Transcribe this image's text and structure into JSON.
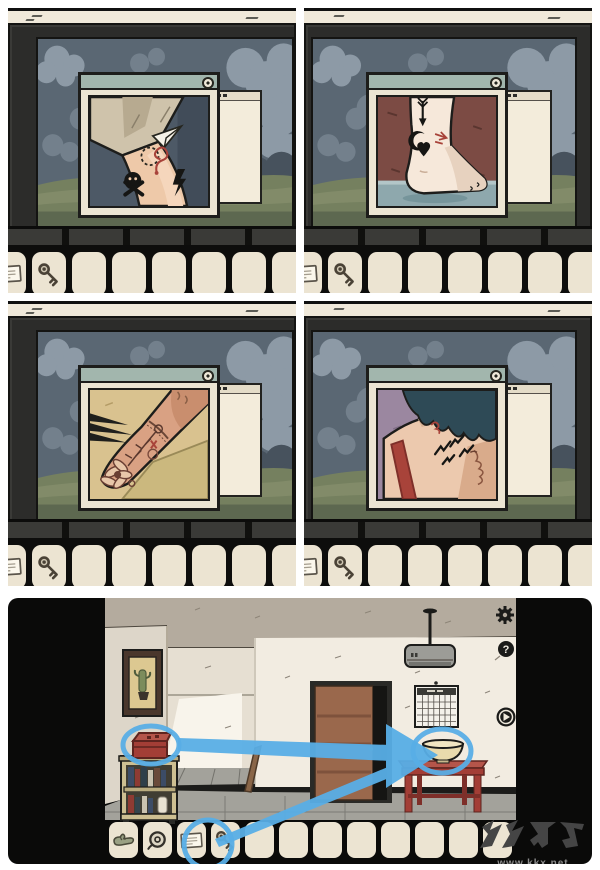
{
  "colors": {
    "page": "#ffffff",
    "sky": "#5a6773",
    "cloud_light": "#8d9aa6",
    "cloud_mid": "#73808c",
    "cloud_dark": "#47525d",
    "ground": "#75805f",
    "ground_light": "#87906e",
    "ground_dark": "#5d6850",
    "frame": "#2c2c2a",
    "cream": "#ece5d3",
    "cream_strip": "#f0e9da",
    "titlebar": "#a2b6ad",
    "slot": "#ece4d2",
    "ink": "#1d1d1b",
    "red_accent": "#a8433a",
    "ceiling": "#b4ab9e",
    "wall": "#f2ece1",
    "wall_side": "#ddd6c9",
    "wall_back": "#e6dfd2",
    "wall_light": "#f8f4eb",
    "floor": "#a3a29b",
    "door": "#9a684c",
    "door_dark": "#7e523c",
    "shelf": "#cdbf92",
    "box_red": "#a33e36",
    "table_red": "#a33e36",
    "bowl": "#e9daad",
    "annotation": "#58aee6",
    "watermark_logo": "#454545",
    "watermark_text": "#8c8c8c"
  },
  "guide": {
    "panels": [
      {
        "name": "step-1",
        "photo_subject": "arm with skull, paper-plane and red note tattoos",
        "inventory": [
          {
            "icon": "note-icon"
          },
          {
            "icon": "key-icon"
          }
        ],
        "empty_slots": 7
      },
      {
        "name": "step-2",
        "photo_subject": "foot and ankle with arrow, crescent-moon and heart tattoos",
        "inventory": [
          {
            "icon": "note-icon"
          },
          {
            "icon": "key-icon"
          }
        ],
        "empty_slots": 7
      },
      {
        "name": "step-3",
        "photo_subject": "wrist with flower and vine tattoos",
        "inventory": [
          {
            "icon": "note-icon"
          },
          {
            "icon": "key-icon"
          }
        ],
        "empty_slots": 7
      },
      {
        "name": "step-4",
        "photo_subject": "back of neck with flying-bird tattoos",
        "inventory": [
          {
            "icon": "note-icon"
          },
          {
            "icon": "key-icon"
          }
        ],
        "empty_slots": 7
      }
    ],
    "window_ui": {
      "close_button": "circle-close-button",
      "background_window": "stacked-window"
    }
  },
  "bottom_scene": {
    "hud": {
      "settings_icon": "gear-icon",
      "help_glyph": "?",
      "play_icon": "play-icon"
    },
    "objects": [
      "cactus-painting",
      "bookshelf",
      "red-box",
      "wooden-plank",
      "door",
      "calendar",
      "ceiling-lamp",
      "red-table",
      "bowl"
    ],
    "inventory": {
      "items": [
        {
          "icon": "glove-icon"
        },
        {
          "icon": "tape-icon"
        },
        {
          "icon": "note-icon"
        },
        {
          "icon": "key-icon"
        }
      ],
      "empty_slots": 8
    },
    "annotations": {
      "color": "#58aee6",
      "highlights": [
        "red-box",
        "key-item",
        "bowl"
      ],
      "arrows": [
        {
          "from": "red-box",
          "to": "bowl"
        },
        {
          "from": "key-item",
          "to": "bowl"
        }
      ]
    },
    "watermark": {
      "logo_text": "KK下载",
      "url": "www.kkx.net"
    }
  }
}
